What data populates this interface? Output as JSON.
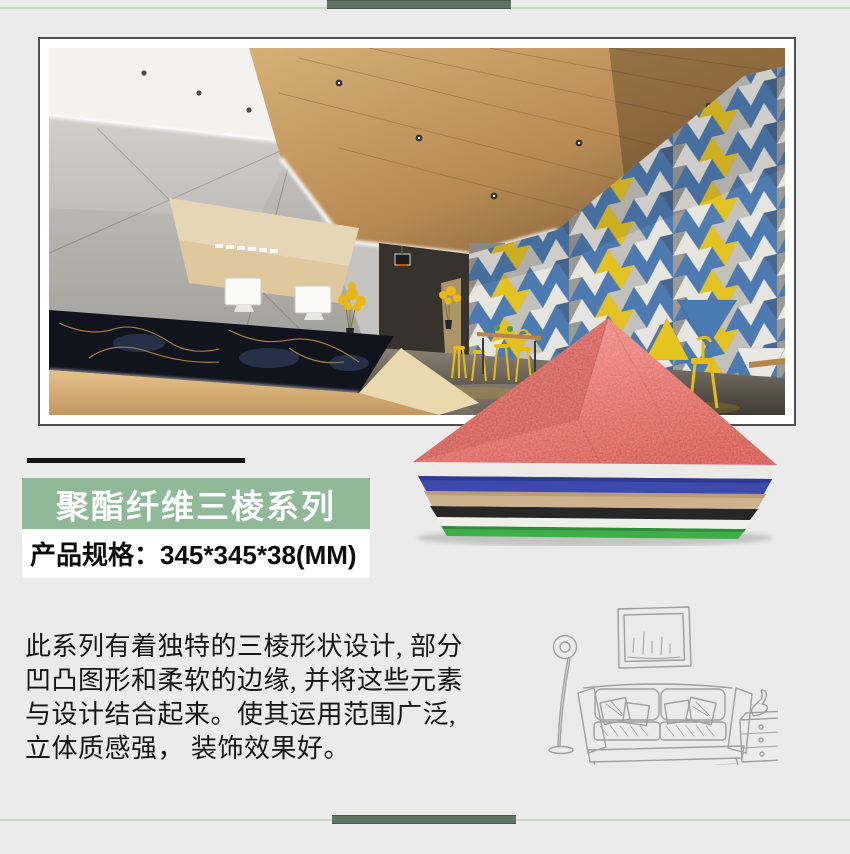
{
  "page": {
    "background": "#ebebeb"
  },
  "decor": {
    "top_bar_color": "#5e7264",
    "bottom_bar_color": "#5e7264",
    "thin_line_color": "#c9d8c9"
  },
  "photo": {
    "name": "showroom-lobby-photo",
    "frame_border_color": "#4f4f4f",
    "feature_wall_colors": {
      "blue": "#4a7ab2",
      "white": "#e9e8e3",
      "yellow": "#e6c41f"
    }
  },
  "series_banner": {
    "label": "聚酯纤维三棱系列",
    "background": "#8fb998",
    "underline_color": "#141414"
  },
  "spec": {
    "text": "产品规格：345*345*38(MM)"
  },
  "description": {
    "lines": [
      "此系列有着独特的三棱形状设计, 部分",
      "凹凸图形和柔软的边缘, 并将这些元素",
      "与设计结合起来。使其运用范围广泛,",
      "立体质感强， 装饰效果好。"
    ]
  },
  "product_stack": {
    "name": "triangle-acoustic-panel-stack",
    "top_panel_color": "#e06a62",
    "layer_colors": [
      "#e8e8e5",
      "#3d49ad",
      "#ccb28e",
      "#272727",
      "#efefec",
      "#3fae49"
    ]
  },
  "sketch": {
    "name": "living-room-line-sketch",
    "stroke_color": "#9f9f9f"
  }
}
